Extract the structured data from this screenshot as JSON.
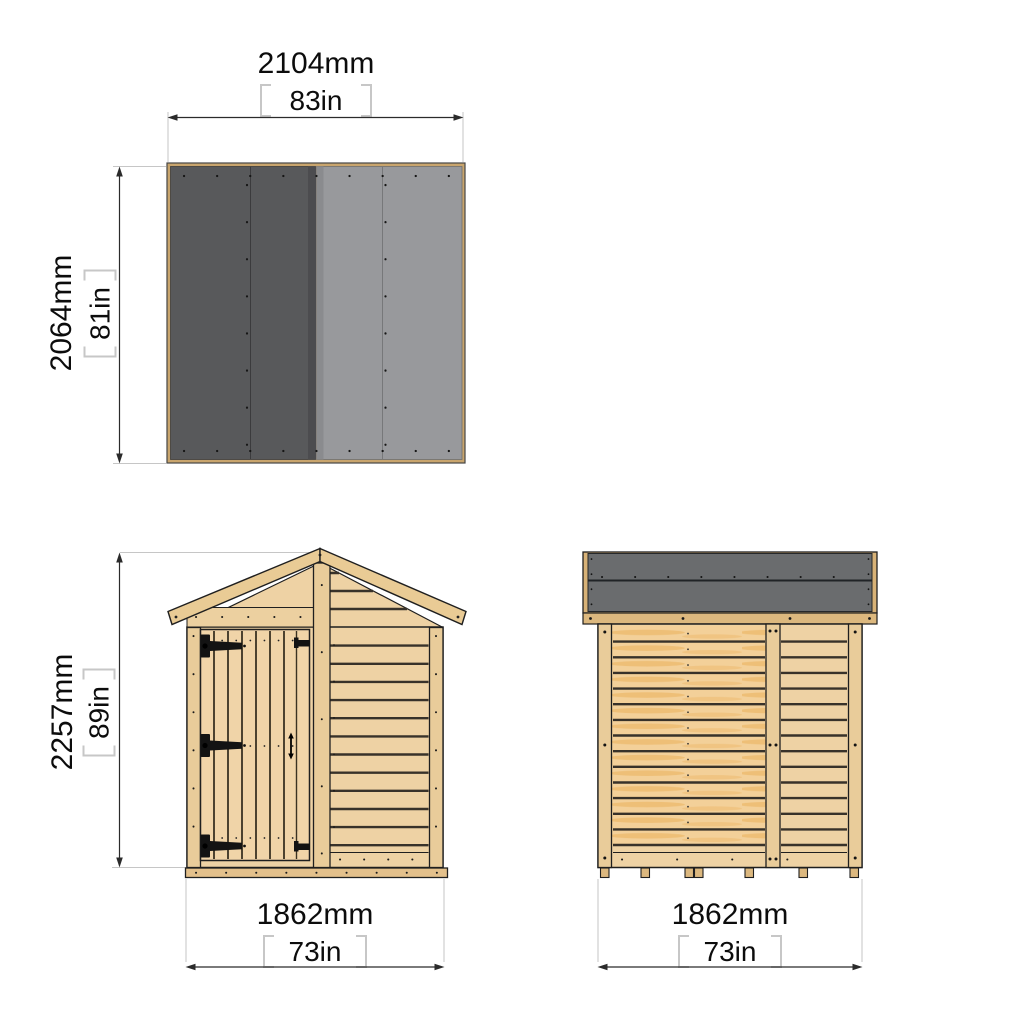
{
  "views": {
    "roof_plan": {
      "dim_width": {
        "mm": "2104mm",
        "in": "83in"
      },
      "dim_depth": {
        "mm": "2064mm",
        "in": "81in"
      }
    },
    "front_elevation": {
      "dim_height": {
        "mm": "2257mm",
        "in": "89in"
      },
      "dim_width": {
        "mm": "1862mm",
        "in": "73in"
      }
    },
    "rear_elevation": {
      "dim_width": {
        "mm": "1862mm",
        "in": "73in"
      }
    }
  },
  "colors": {
    "wood": "#eed2a4",
    "wood_trim": "#e9cb95",
    "roof_felt_dark": "#58595b",
    "roof_felt_light": "#98999c",
    "roof_side_grey": "#6a6c6e",
    "outline": "#1f1f1f",
    "dimension_line": "#2b2b2b",
    "extension_line": "#c6c6c6"
  }
}
